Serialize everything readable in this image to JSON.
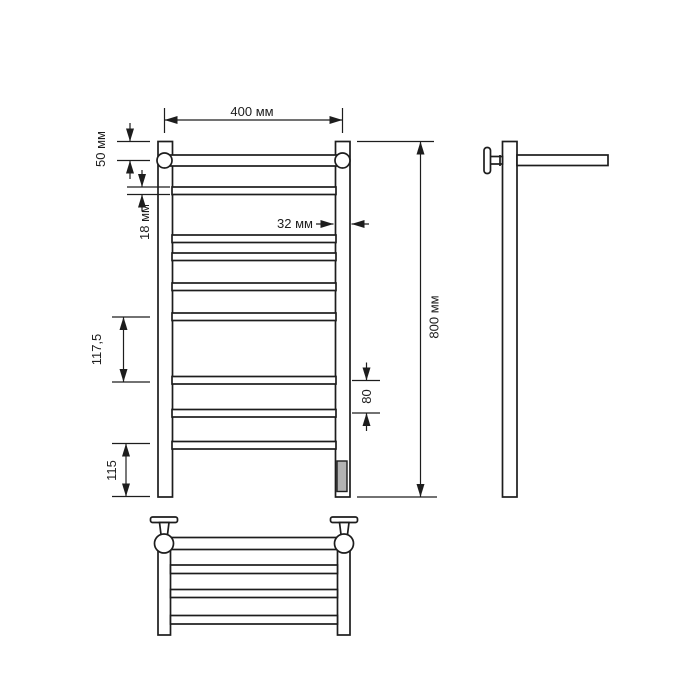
{
  "labels": {
    "top_width": "400 мм",
    "top_offset": "50 мм",
    "tube_size": "18 мм",
    "post_width": "32 мм",
    "mid_spacing": "117,5",
    "bottom_offset": "115",
    "lower_spacing": "80",
    "height": "800 мм"
  },
  "colors": {
    "line": "#1d1d1d",
    "background": "#ffffff",
    "heating_element_fill": "#b3b3b3"
  }
}
